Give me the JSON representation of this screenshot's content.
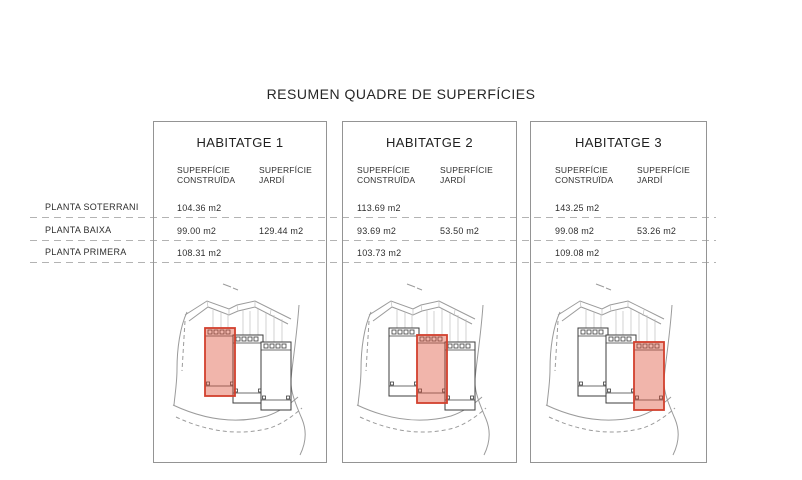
{
  "title": "RESUMEN QUADRE DE SUPERFÍCIES",
  "row_labels": [
    "PLANTA SOTERRANI",
    "PLANTA BAIXA",
    "PLANTA PRIMERA"
  ],
  "columns": {
    "construida": "SUPERFÍCIE\nCONSTRUÏDA",
    "jardi": "SUPERFÍCIE\nJARDÍ"
  },
  "panels": [
    {
      "title": "HABITATGE 1",
      "soterrani_construida": "104.36 m2",
      "baixa_construida": "99.00 m2",
      "baixa_jardi": "129.44 m2",
      "primera_construida": "108.31 m2",
      "highlighted_unit": "left"
    },
    {
      "title": "HABITATGE 2",
      "soterrani_construida": "113.69 m2",
      "baixa_construida": "93.69 m2",
      "baixa_jardi": "53.50 m2",
      "primera_construida": "103.73 m2",
      "highlighted_unit": "middle"
    },
    {
      "title": "HABITATGE 3",
      "soterrani_construida": "143.25 m2",
      "baixa_construida": "99.08 m2",
      "baixa_jardi": "53.26 m2",
      "primera_construida": "109.08 m2",
      "highlighted_unit": "right"
    }
  ],
  "colors": {
    "highlight_fill": "#dd4f38",
    "highlight_stroke": "#d2402e",
    "panel_border": "#949494",
    "dash_color": "#b3b3b3",
    "plan_line": "#9b9b9b",
    "unit_line": "#3d3d3d",
    "text_color": "#2b2b2b"
  }
}
